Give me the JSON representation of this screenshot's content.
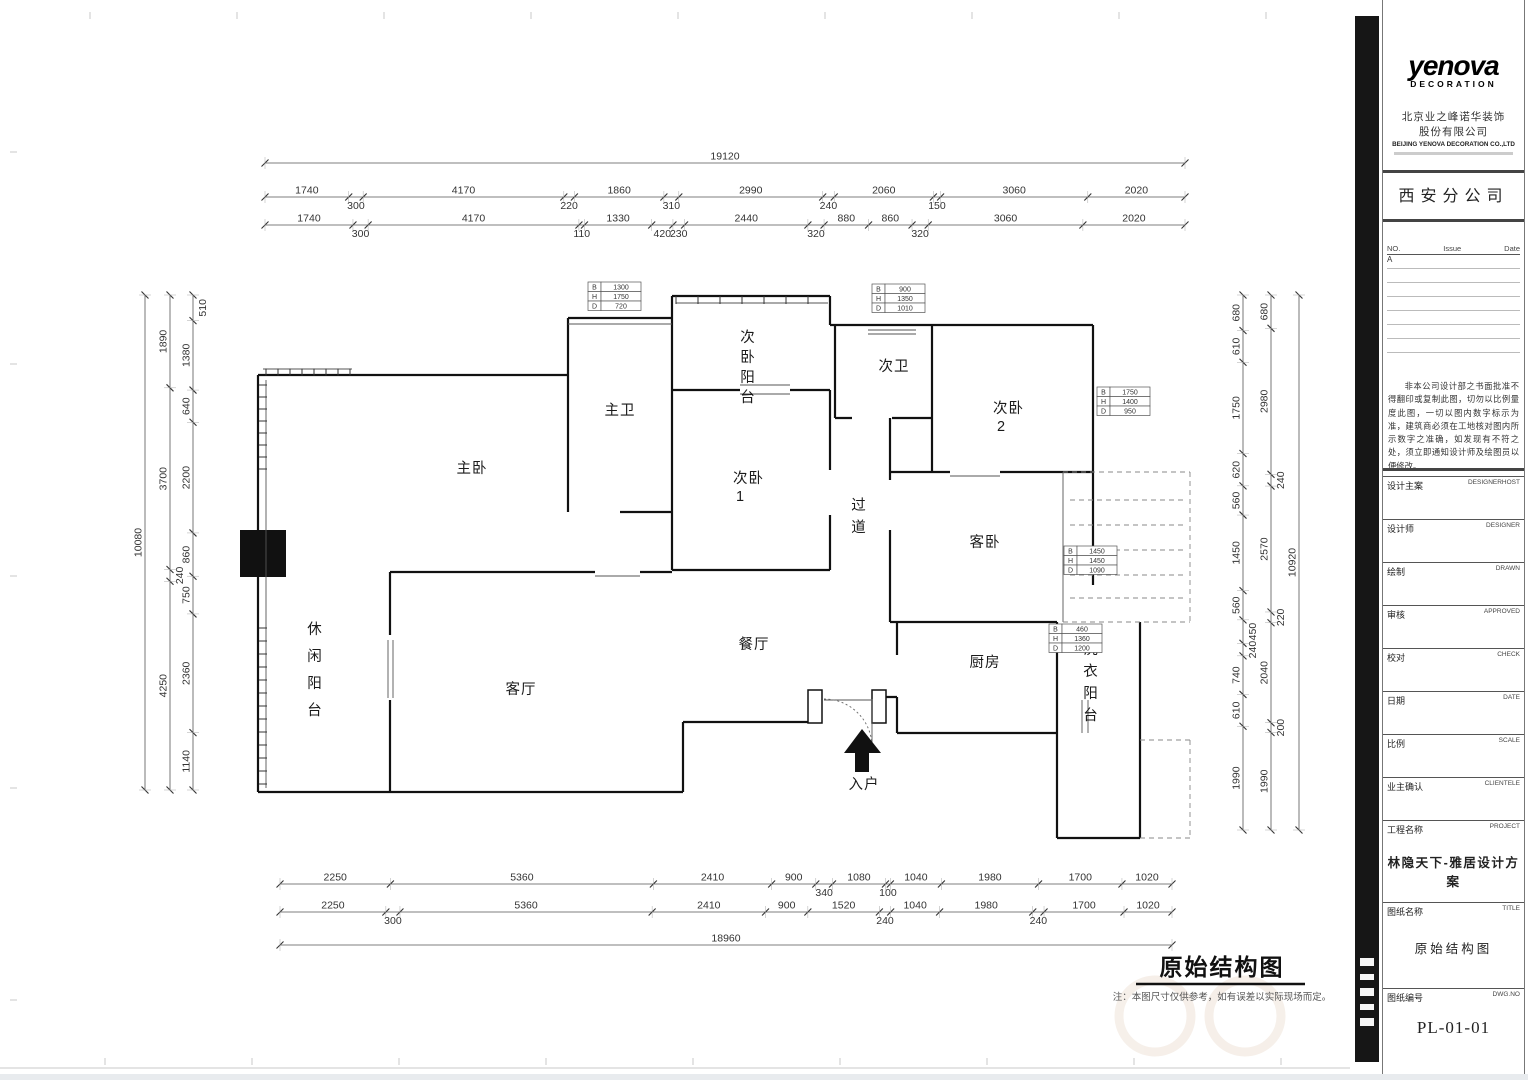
{
  "sheet": {
    "plan_title": "原始结构图",
    "plan_note": "注：本图尺寸仅供参考，如有误差以实际现场而定。"
  },
  "rooms": {
    "master_bedroom": "主卧",
    "master_bath": "主卫",
    "bed2_balcony": "次卧阳台",
    "bedroom1_l1": "次卧",
    "bedroom1_l2": "1",
    "second_bath": "次卫",
    "bedroom2_l1": "次卧",
    "bedroom2_l2": "2",
    "corridor": "过道",
    "guest_bedroom": "客卧",
    "dining": "餐厅",
    "kitchen": "厨房",
    "laundry_balcony": "洗衣阳台",
    "living": "客厅",
    "leisure_balcony": "休闲阳台",
    "entry": "入户"
  },
  "dims": {
    "top": {
      "overall": "19120",
      "row1": [
        "1740",
        "300",
        "4170",
        "220",
        "1860",
        "310",
        "2990",
        "240",
        "2060",
        "150",
        "3060",
        "2020"
      ],
      "row2": [
        "1740",
        "300",
        "4170",
        "110",
        "1330",
        "420",
        "230",
        "2440",
        "320",
        "880",
        "860",
        "320",
        "3060",
        "2020"
      ]
    },
    "bottom": {
      "overall": "18960",
      "row1": [
        "2250",
        "5360",
        "2410",
        "900",
        "340",
        "1080",
        "100",
        "1040",
        "1980",
        "1700",
        "1020"
      ],
      "row2": [
        "2250",
        "300",
        "5360",
        "2410",
        "900",
        "1520",
        "240",
        "1040",
        "1980",
        "240",
        "1700",
        "1020"
      ]
    },
    "left": {
      "overall": "10080",
      "mid": [
        "1890",
        "3700",
        "240",
        "4250"
      ],
      "inner": [
        "510",
        "1380",
        "640",
        "2200",
        "860",
        "750",
        "2360",
        "1140"
      ]
    },
    "right": {
      "overall": "10920",
      "mid": [
        "680",
        "2980",
        "240",
        "2570",
        "220",
        "2040",
        "200",
        "1990"
      ],
      "inner": [
        "680",
        "610",
        "1750",
        "620",
        "560",
        "1450",
        "560",
        "450",
        "240",
        "740",
        "610",
        "1990"
      ]
    }
  },
  "window_tags": [
    {
      "b": "1300",
      "h": "1750",
      "d": "720"
    },
    {
      "b": "900",
      "h": "1350",
      "d": "1010"
    },
    {
      "b": "1750",
      "h": "1400",
      "d": "950"
    },
    {
      "b": "1450",
      "h": "1450",
      "d": "1090"
    },
    {
      "b": "460",
      "h": "1360",
      "d": "1200"
    }
  ],
  "title_block": {
    "logo": "yenova",
    "logo_sub": "DECORATION",
    "company_cn1": "北京业之峰诺华装饰",
    "company_cn2": "股份有限公司",
    "company_en": "BEIJING YENOVA DECORATION CO.,LTD",
    "branch": "西安分公司",
    "revision": {
      "no": "NO.",
      "issue": "Issue",
      "date": "Date",
      "row1": "A"
    },
    "disclaimer": "非本公司设计部之书面批准不得翻印或复制此图，切勿以比例量度此图，一切以图内数字标示为准，建筑商必须在工地核对图内所示数字之准确，如发现有不符之处，须立即通知设计师及绘图员以便修改。",
    "fields": [
      {
        "cn": "设计主案",
        "en": "DESIGNERHOST"
      },
      {
        "cn": "设计师",
        "en": "DESIGNER"
      },
      {
        "cn": "绘制",
        "en": "DRAWN"
      },
      {
        "cn": "审核",
        "en": "APPROVED"
      },
      {
        "cn": "校对",
        "en": "CHECK"
      },
      {
        "cn": "日期",
        "en": "DATE"
      },
      {
        "cn": "比例",
        "en": "SCALE"
      },
      {
        "cn": "业主确认",
        "en": "CLIENTELE"
      }
    ],
    "project_label_cn": "工程名称",
    "project_label_en": "PROJECT",
    "project_name": "林隐天下-雅居设计方案",
    "drawing_label_cn": "图纸名称",
    "drawing_label_en": "TITLE",
    "drawing_name": "原始结构图",
    "dwg_label_cn": "图纸编号",
    "dwg_label_en": "DWG.NO",
    "dwg_no": "PL-01-01"
  }
}
